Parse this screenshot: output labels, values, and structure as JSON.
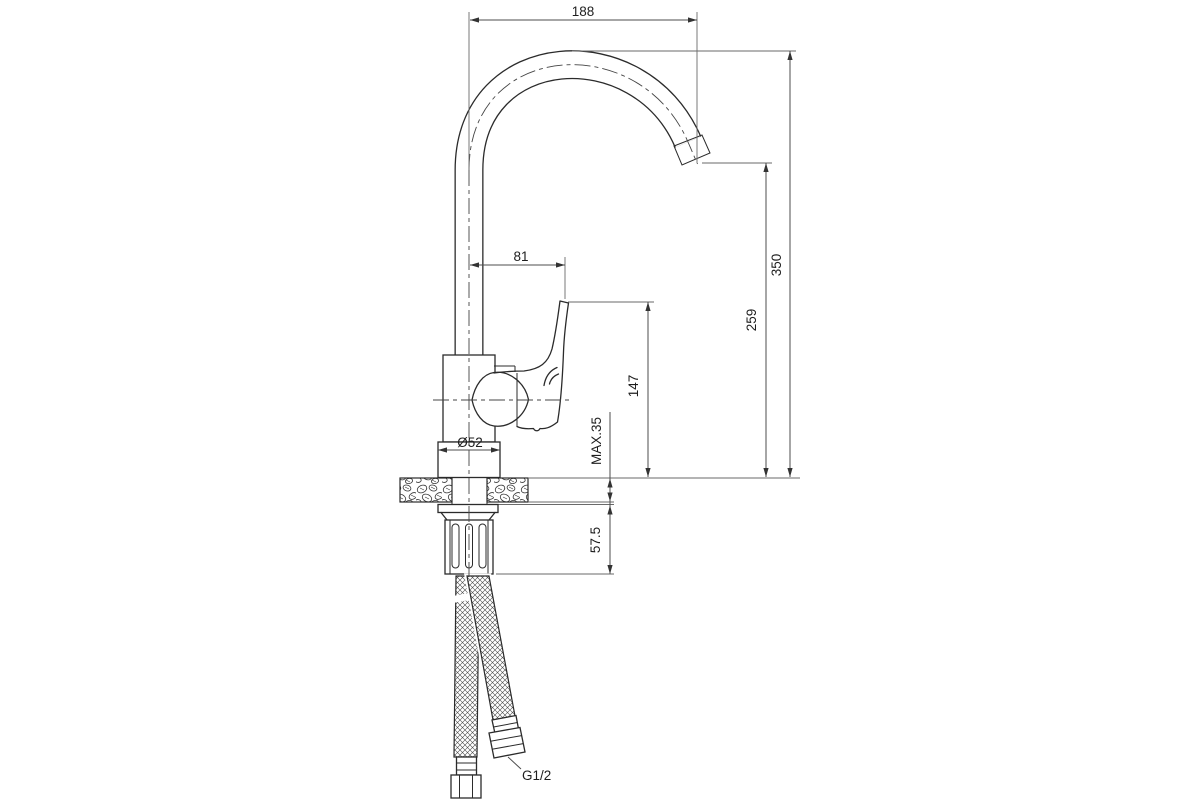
{
  "drawing": {
    "type": "technical-dimension-drawing",
    "subject": "single-lever kitchen faucet, side elevation with installation dimensions",
    "units": "mm",
    "labels": {
      "spout_reach": "188",
      "overall_height": "350",
      "spout_outlet_height": "259",
      "handle_tip_height": "147",
      "handle_reach": "81",
      "body_diameter": "Ø52",
      "max_counter_thickness": "MAX.35",
      "under_counter_length": "57.5",
      "hose_thread": "G1/2"
    },
    "colors": {
      "background": "#ffffff",
      "object_line": "#2b2b2b",
      "dimension_line": "#4d4d4d",
      "text": "#1e1e1e"
    }
  }
}
